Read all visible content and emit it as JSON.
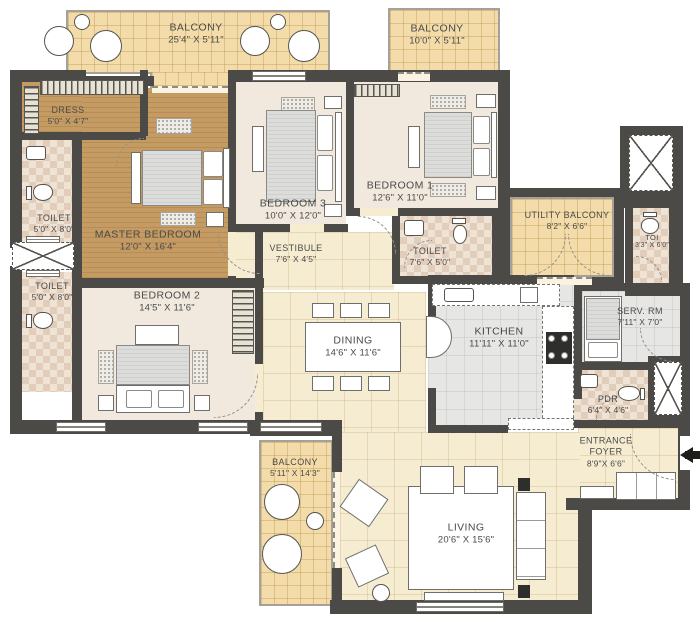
{
  "palette": {
    "wall": "#4b4a46",
    "balcony_floor": "#f3dcaa",
    "wood_floor": "#c59b64",
    "tile_floor": "#f6ecd1",
    "kitchen_floor": "#e6e6e4",
    "toilet_floor": "#efe3d6",
    "label_text": "#4a4a4a"
  },
  "rooms": {
    "balcony_top": {
      "name": "BALCONY",
      "dims": "25'4\" X 5'11\""
    },
    "balcony_top_right": {
      "name": "BALCONY",
      "dims": "10'0\" X 5'11\""
    },
    "dress": {
      "name": "DRESS",
      "dims": "5'0\" X 4'7\""
    },
    "toilet_upper_left": {
      "name": "TOILET",
      "dims": "5'0\" X 8'0\""
    },
    "toilet_lower_left": {
      "name": "TOILET",
      "dims": "5'0\" X 8'0\""
    },
    "master_bedroom": {
      "name": "MASTER BEDROOM",
      "dims": "12'0\" X 16'4\""
    },
    "bedroom3": {
      "name": "BEDROOM 3",
      "dims": "10'0\" X 12'0\""
    },
    "bedroom1": {
      "name": "BEDROOM 1",
      "dims": "12'6\" X 11'0\""
    },
    "vestibule": {
      "name": "VESTIBULE",
      "dims": "7'6\" X 4'5\""
    },
    "toilet_mid": {
      "name": "TOILET",
      "dims": "7'6\" X 5'0\""
    },
    "utility_balcony": {
      "name": "UTILITY BALCONY",
      "dims": "8'2\" X 6'6\""
    },
    "toilet_right": {
      "name": "TOI",
      "dims": "3'3\" X 6'0\""
    },
    "kitchen": {
      "name": "KITCHEN",
      "dims": "11'11\" X 11'0\""
    },
    "serv_rm": {
      "name": "SERV. RM",
      "dims": "7'11\" X 7'0\""
    },
    "pdr": {
      "name": "PDR",
      "dims": "6'4\" X 4'6\""
    },
    "entrance_foyer": {
      "name": "ENTRANCE FOYER",
      "dims": "8'9\"X 6'6\""
    },
    "bedroom2": {
      "name": "BEDROOM 2",
      "dims": "14'5\" X 11'6\""
    },
    "dining": {
      "name": "DINING",
      "dims": "14'6\" X 11'6\""
    },
    "balcony_bottom": {
      "name": "BALCONY",
      "dims": "5'11\" X 14'3\""
    },
    "living": {
      "name": "LIVING",
      "dims": "20'6\" X 15'6\""
    }
  }
}
